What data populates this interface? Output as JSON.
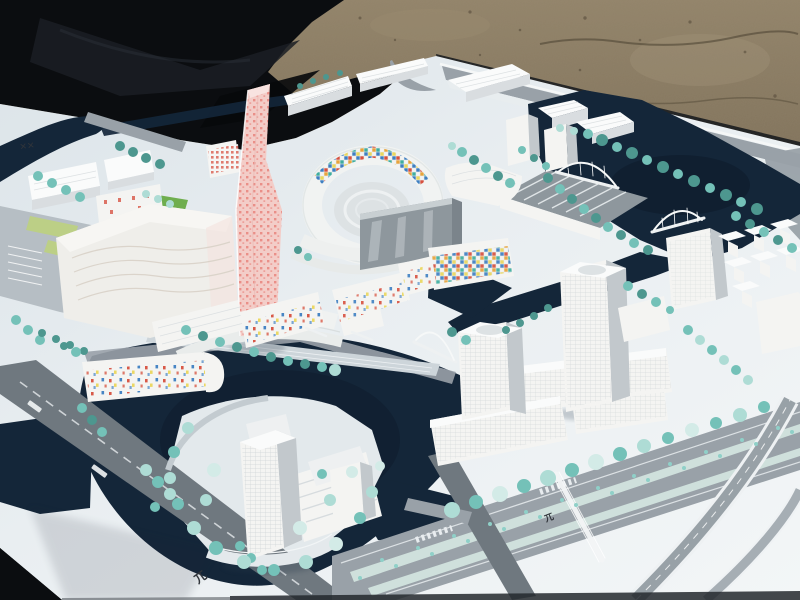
{
  "scene": {
    "description": "Outdoor photograph of a white architectural scale model of a canal-side urban district on a presentation board; black tarp upper-left, gravel ground above, navy waterways, teal model trees, one pink patterned tower and mosaic-tiled courtyard building in the center",
    "palette": {
      "sand": "#8a7a61",
      "sand-dark": "#675a46",
      "sand-light": "#a2947a",
      "tarp": "#0b0d10",
      "tarp-fold": "#1b1f25",
      "board": "#e9eef1",
      "board-bright": "#f4f7f8",
      "board-shadow": "#c7d2d8",
      "water": "#142639",
      "water-deep": "#0d1b2b",
      "road": "#99a1a8",
      "road-dark": "#6f787f",
      "road-light": "#b6bec4",
      "median": "#cfe0dc",
      "building": "#f4f4f2",
      "building-shade": "#d9dde0",
      "building-dark": "#c2c8cc",
      "roof": "#fafbfb",
      "glass": "#8e979d",
      "island": "#e3e9ec",
      "lawn": "#bccf86",
      "lawn-green": "#6fae4e",
      "tree": "#74c1b8",
      "tree-light": "#aedcd5",
      "tree-dark": "#4d978f",
      "tree-pale": "#d3ebe7",
      "mosaic-red": "#d7503e",
      "mosaic-blue": "#3e7fc2",
      "mosaic-orange": "#e8a43b",
      "mosaic-teal": "#3fae9f",
      "mosaic-yellow": "#ead75c",
      "pink": "#f3cdc8",
      "pink-dot": "#ea8f88",
      "marking": "#30343a"
    },
    "markings": {
      "corner_glyph": "✕✕",
      "rail_glyph": "兀",
      "rail_glyph_small": "兀"
    }
  }
}
